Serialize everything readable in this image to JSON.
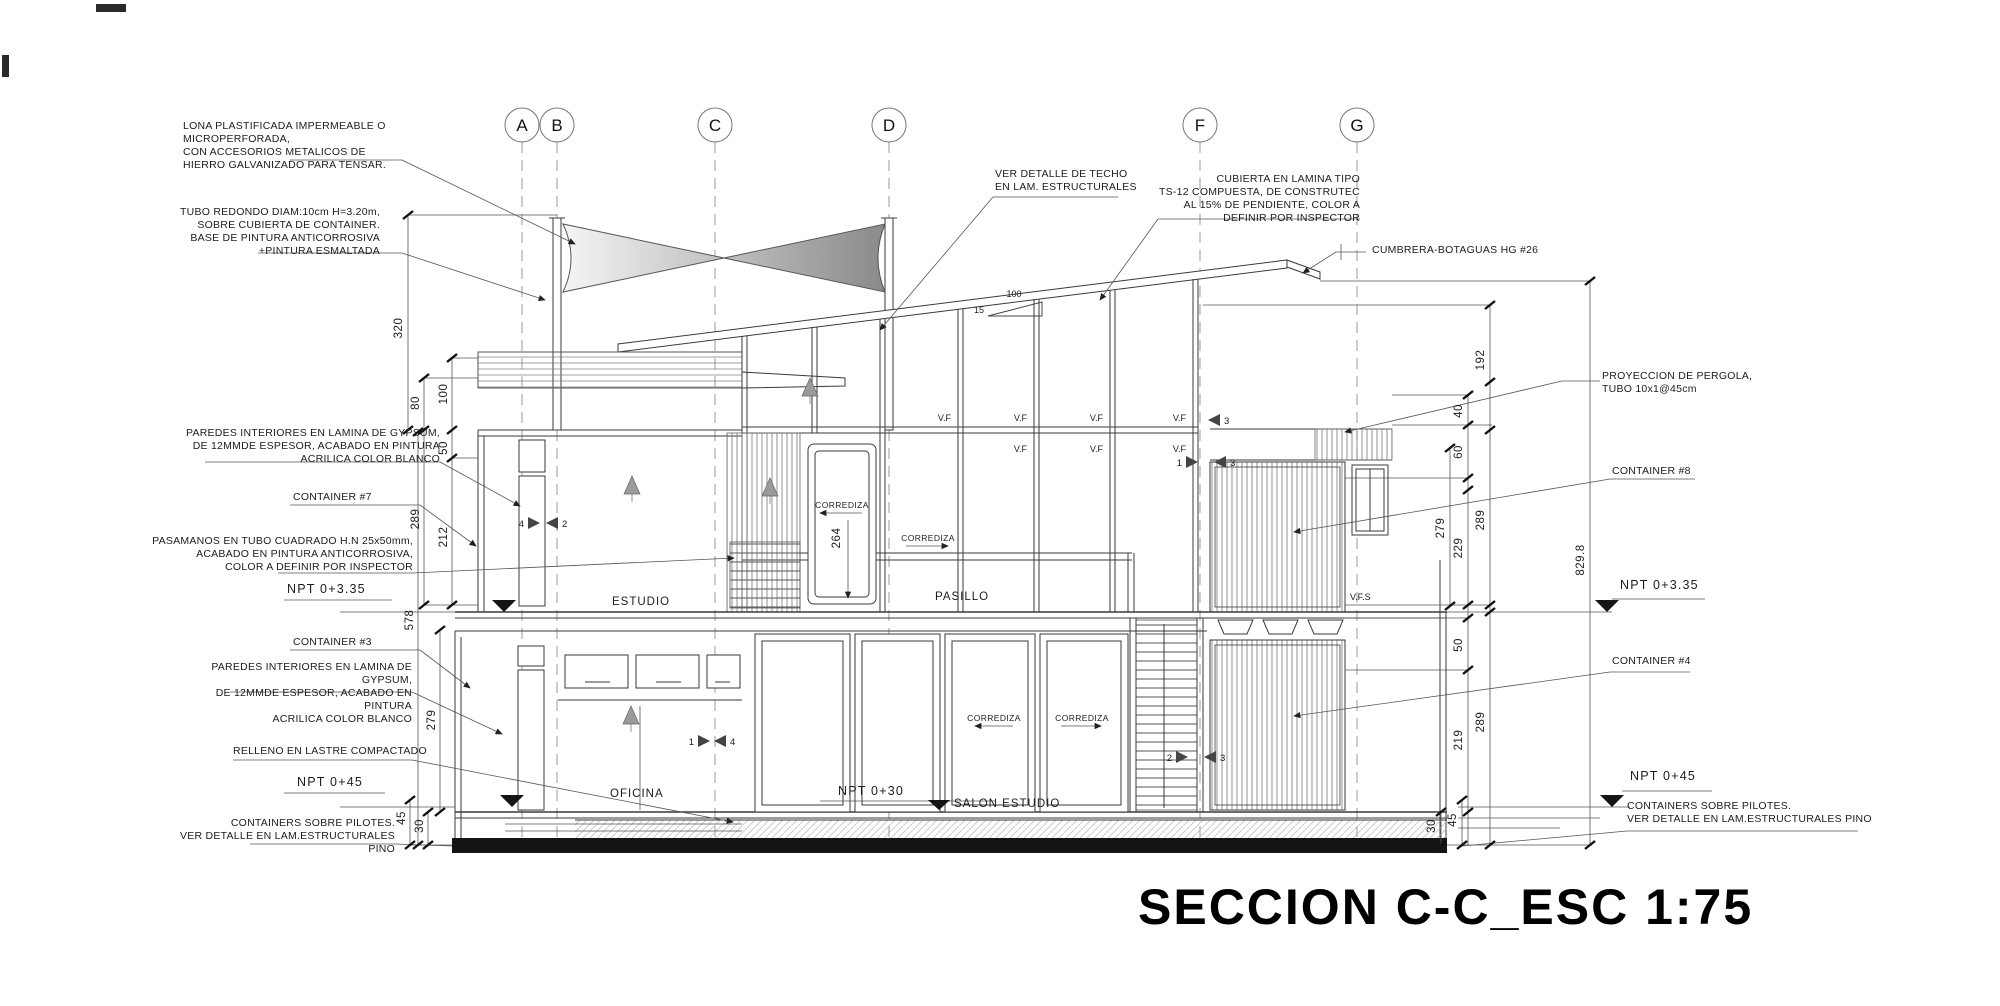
{
  "title": "SECCION C-C_ESC 1:75",
  "grid": {
    "bubbles": [
      "A",
      "B",
      "C",
      "D",
      "F",
      "G"
    ]
  },
  "annotations": {
    "lona": "LONA PLASTIFICADA IMPERMEABLE O MICROPERFORADA,\nCON ACCESORIOS METALICOS DE\nHIERRO GALVANIZADO PARA TENSAR.",
    "tubo": "TUBO REDONDO DIAM:10cm H=3.20m,\nSOBRE CUBIERTA DE CONTAINER.\nBASE DE PINTURA ANTICORROSIVA\n+PINTURA ESMALTADA",
    "ver_detalle_techo": "VER DETALLE DE TECHO\nEN LAM. ESTRUCTURALES",
    "cubierta": "CUBIERTA EN LAMINA TIPO\nTS-12 COMPUESTA, DE CONSTRUTEC\nAL 15% DE PENDIENTE, COLOR A\nDEFINIR POR INSPECTOR",
    "cumbrera": "CUMBRERA-BOTAGUAS HG #26",
    "pergola": "PROYECCION DE PERGOLA,\nTUBO 10x1@45cm",
    "container8": "CONTAINER #8",
    "paredes_gypsum": "PAREDES INTERIORES EN LAMINA DE GYPSUM,\nDE 12MMDE ESPESOR, ACABADO EN PINTURA\nACRILICA COLOR BLANCO",
    "container7": "CONTAINER #7",
    "pasamanos": "PASAMANOS EN TUBO CUADRADO H.N 25x50mm,\nACABADO EN PINTURA ANTICORROSIVA,\nCOLOR A DEFINIR POR INSPECTOR",
    "npt_335": "NPT 0+3.35",
    "container3": "CONTAINER #3",
    "relleno": "RELLENO EN LASTRE COMPACTADO",
    "npt_045": "NPT 0+45",
    "pilotes": "CONTAINERS SOBRE PILOTES.\nVER DETALLE EN LAM.ESTRUCTURALES PINO",
    "container4": "CONTAINER #4"
  },
  "rooms": {
    "estudio": "ESTUDIO",
    "pasillo": "PASILLO",
    "oficina": "OFICINA",
    "npt_030": "NPT 0+30",
    "salon_estudio": "SALON ESTUDIO"
  },
  "doors": {
    "corrediza": "CORREDIZA"
  },
  "windows": {
    "vf": "V.F",
    "vfs": "V.F.S"
  },
  "slope": {
    "run": "100",
    "rise": "15"
  },
  "dims": {
    "left": [
      "320",
      "80",
      "100",
      "50",
      "289",
      "212",
      "578",
      "279",
      "45",
      "30"
    ],
    "right": [
      "192",
      "40",
      "60",
      "279",
      "229",
      "289",
      "829.8",
      "50",
      "219",
      "289",
      "45",
      "30"
    ],
    "center": "264"
  },
  "markers": {
    "m4a": "4",
    "m2a": "2",
    "m1a": "1",
    "m4b": "4",
    "m3a": "3",
    "m1b": "1",
    "m3b": "3",
    "m2b": "2",
    "m3c": "3"
  }
}
